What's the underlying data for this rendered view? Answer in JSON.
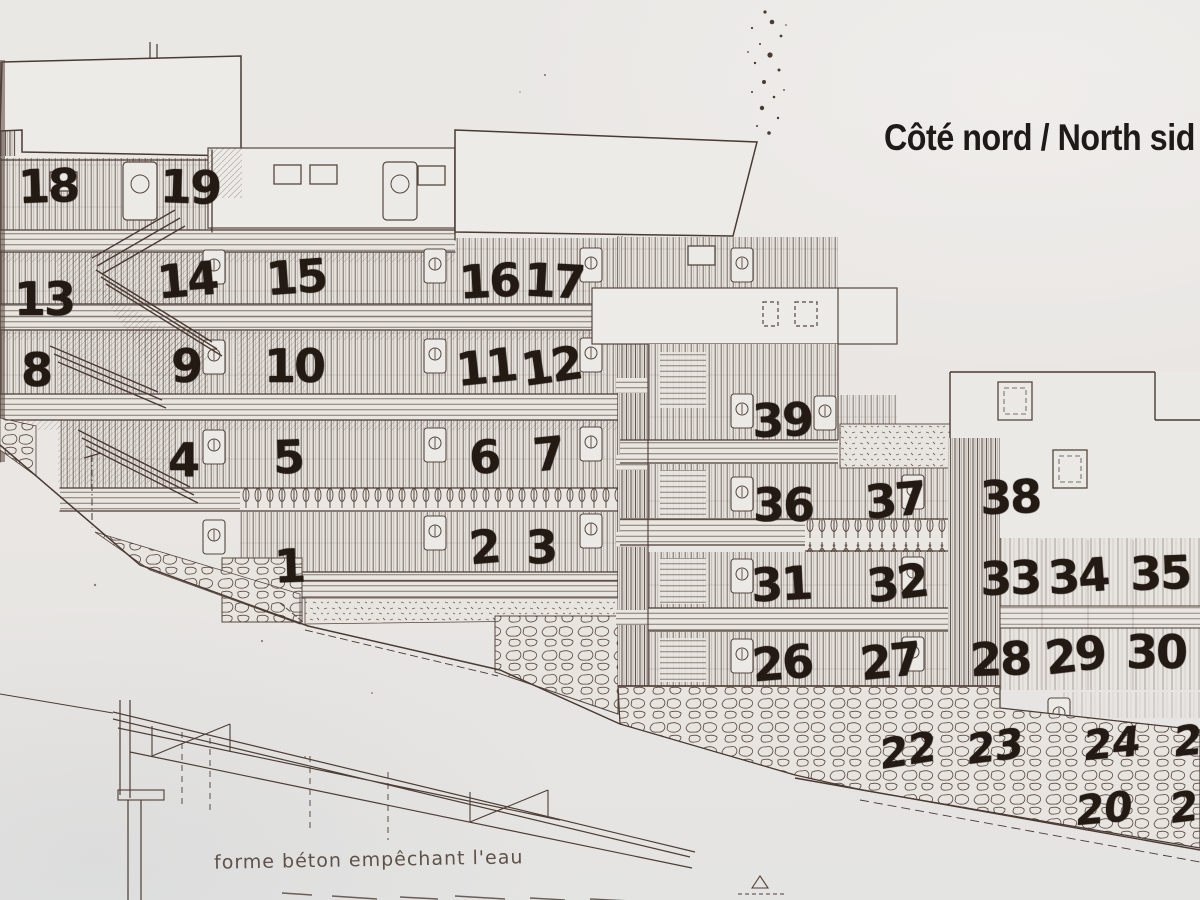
{
  "header": {
    "title": "Côté nord / North sid"
  },
  "elevation": {
    "rows": [
      {
        "units": [
          "18",
          "19"
        ]
      },
      {
        "units": [
          "13",
          "14",
          "15",
          "16",
          "17"
        ]
      },
      {
        "units": [
          "8",
          "9",
          "10",
          "11",
          "12"
        ]
      },
      {
        "units": [
          "4",
          "5",
          "6",
          "7"
        ]
      },
      {
        "units": [
          "1",
          "2",
          "3"
        ]
      },
      {
        "units": [
          "39"
        ]
      },
      {
        "units": [
          "36",
          "37",
          "38"
        ]
      },
      {
        "units": [
          "31",
          "32",
          "33",
          "34",
          "35"
        ]
      },
      {
        "units": [
          "26",
          "27",
          "28",
          "29",
          "30"
        ]
      },
      {
        "units": [
          "22",
          "23",
          "24",
          "25"
        ]
      },
      {
        "units": [
          "20",
          "21"
        ]
      }
    ]
  },
  "annotation": {
    "text": "forme béton empêchant l'eau"
  },
  "colors": {
    "paper": "#e9e6e3",
    "ink": "#57463e",
    "numbers": "#241a14",
    "title": "#1d1a17"
  }
}
